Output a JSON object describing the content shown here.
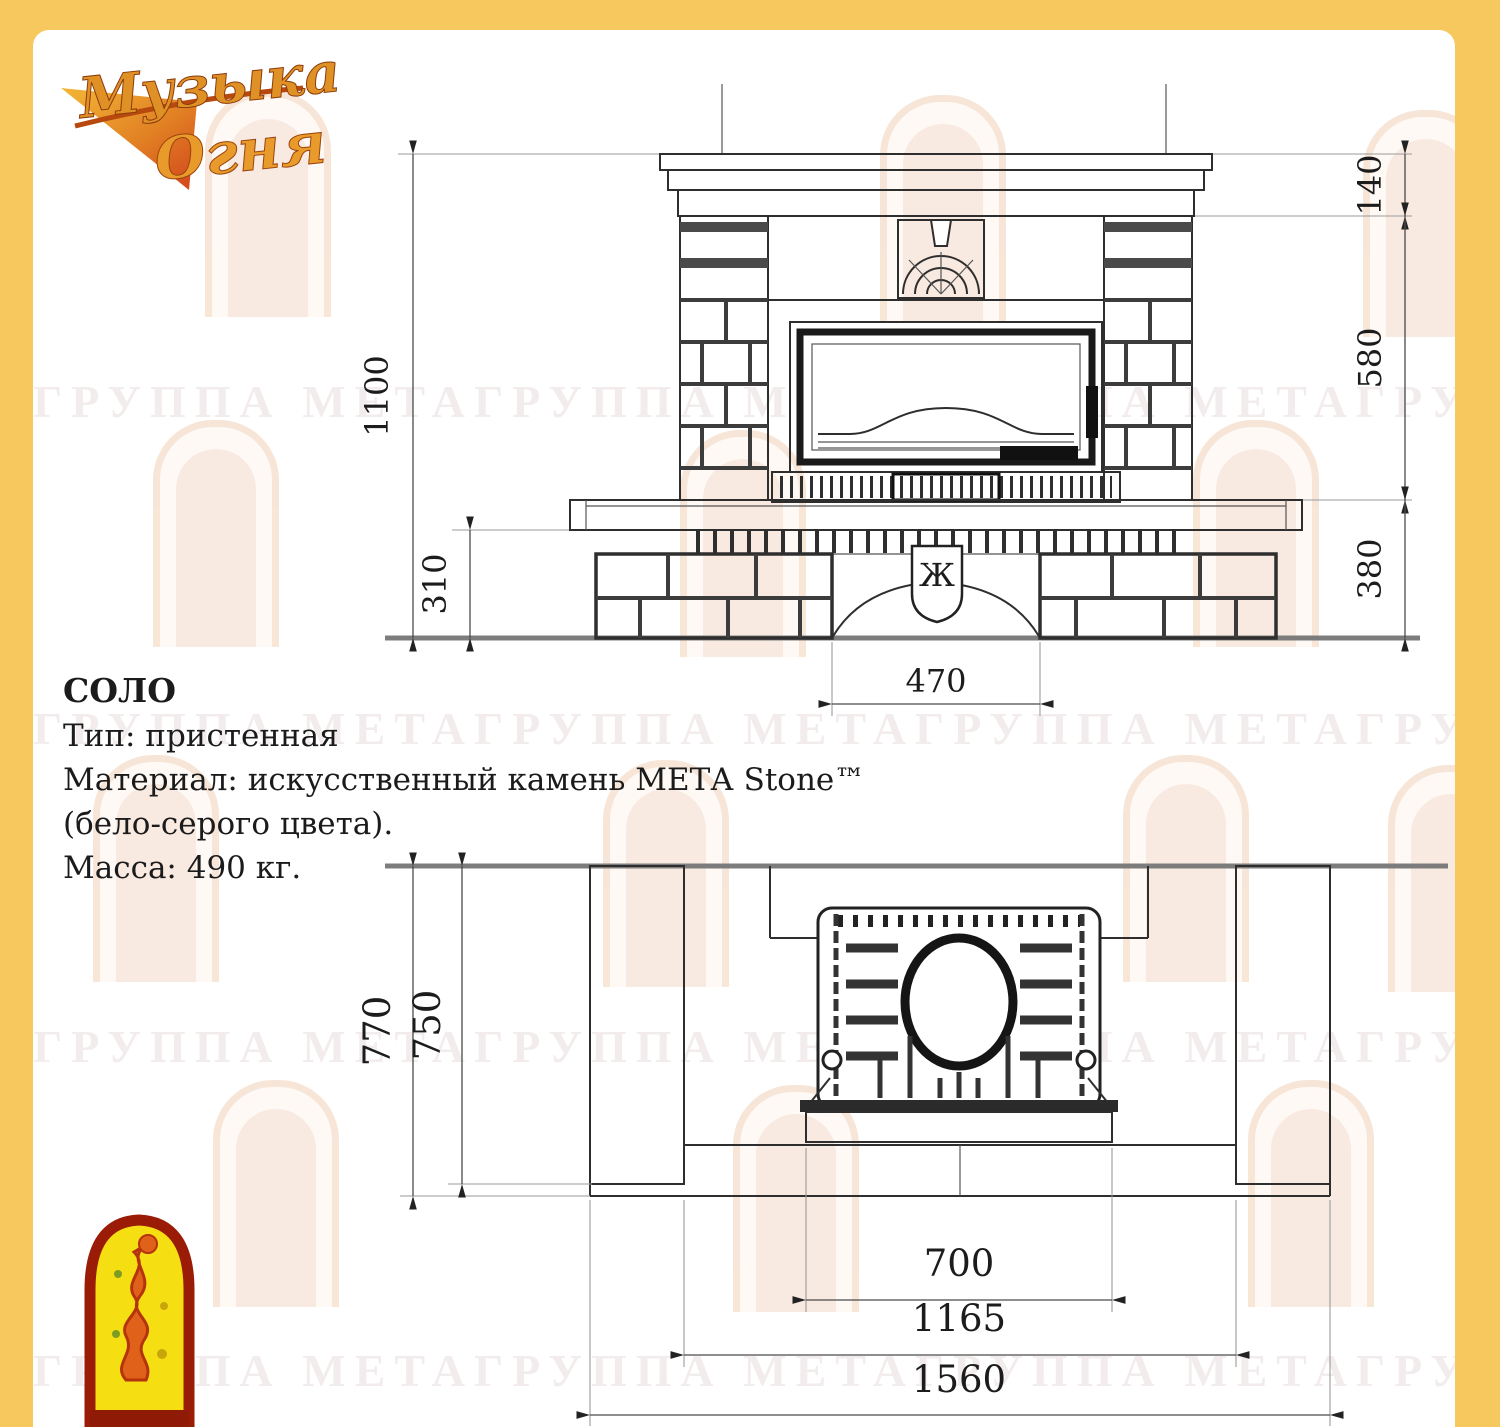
{
  "colors": {
    "frame_yellow": "#f6c85e",
    "paper_white": "#ffffff",
    "drawing_line": "#2e2e2e",
    "ground_gray": "#7c7c7c",
    "logo_gold": "#df9126",
    "logo_red": "#9a1c06"
  },
  "brand": {
    "logo_line1": "Музыка",
    "logo_line2": "Огня"
  },
  "watermark": {
    "row_text": "ГРУППА МЕТАГРУППА МЕТАГРУППА МЕТАГРУППА МЕТА"
  },
  "product": {
    "name": "СОЛО",
    "type_line": "Тип: пристенная",
    "material_line1": "Материал: искусственный камень МЕТА Stone™",
    "material_line2": "(бело-серого цвета).",
    "mass_line": "Масса: 490 кг."
  },
  "front_view": {
    "emblem": "Ж",
    "dims": {
      "total_height": "1100",
      "hearth_height": "310",
      "crown_height": "140",
      "middle_height": "580",
      "base_height": "380",
      "arch_width": "470"
    }
  },
  "plan_view": {
    "dims": {
      "total_depth": "770",
      "column_depth": "750",
      "insert_width": "700",
      "inner_width": "1165",
      "total_width": "1560"
    }
  }
}
